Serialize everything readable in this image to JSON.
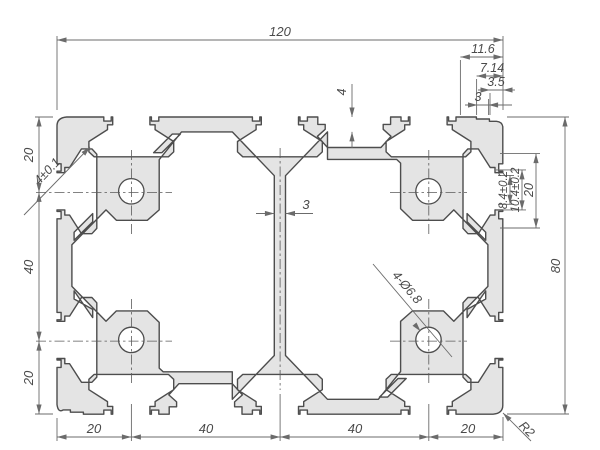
{
  "drawing": {
    "title": "aluminium-extrusion-profile-cross-section",
    "dims": {
      "overall_width": "120",
      "overall_height": "80",
      "corner_detail": [
        "11.6",
        "7.14",
        "3.5",
        "3"
      ],
      "left_chain": [
        "20",
        "40",
        "20"
      ],
      "bottom_chain": [
        "20",
        "40",
        "40",
        "20"
      ],
      "slot_opening": "8.4±0.2",
      "slot_inner": "10.4±0.2",
      "slot_outer": "20",
      "web_thickness": "3",
      "wall_thickness": "4",
      "side_slot": "4±0.1",
      "holes": "4-Ø6.8",
      "corner_radius": "R2"
    },
    "profile": {
      "width_mm": 120,
      "height_mm": 80,
      "slot_centers": [
        20,
        60,
        100
      ],
      "side_slot_centers": [
        20,
        60
      ],
      "groove_center_top": 80,
      "groove_center_bottom": 40,
      "hole_diameter_mm": 6.8,
      "hole_positions_mm": [
        [
          20,
          20
        ],
        [
          100,
          20
        ],
        [
          20,
          60
        ],
        [
          100,
          60
        ]
      ],
      "fill_color": "#e4e4e4",
      "line_color": "#4d4d4d",
      "dim_color": "#6b6b6b"
    }
  }
}
